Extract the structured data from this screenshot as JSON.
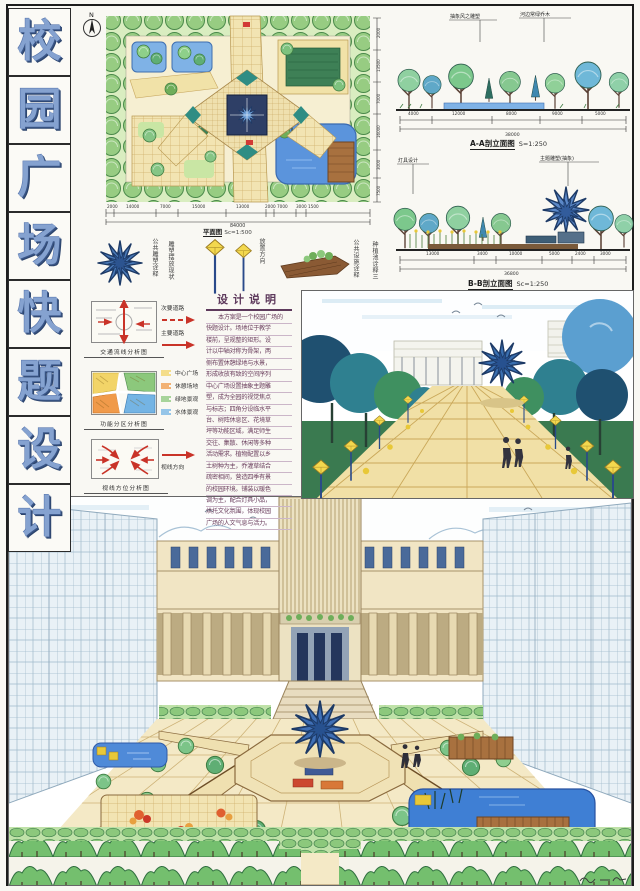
{
  "board": {
    "titles": [
      "校",
      "园",
      "广",
      "场",
      "快",
      "题",
      "设",
      "计"
    ]
  },
  "plan": {
    "north": "N",
    "label": "平面图",
    "scale": "Sc=1:500",
    "dim_total": "84000",
    "dims_bottom": [
      "2000",
      "14000",
      "7000",
      "15000",
      "13000",
      "2000",
      "7000",
      "3000",
      "1500"
    ],
    "dims_right": [
      "2000",
      "13500",
      "7000",
      "16000",
      "3000",
      "7500"
    ]
  },
  "sections": {
    "a": {
      "callout_left": "抽象风之雕塑",
      "callout_right": "河边常绿乔木",
      "label": "A-A剖立面图",
      "scale": "S=1:250",
      "dims": [
        "4000",
        "12000",
        "8000",
        "9000",
        "5000"
      ],
      "total": "38000"
    },
    "b": {
      "callout_left": "灯具设计",
      "callout_right": "主题雕塑(抽象)",
      "label": "B-B剖立面图",
      "scale": "Sc=1:250",
      "dims": [
        "13000",
        "3400",
        "10000",
        "5000",
        "2400",
        "3000"
      ],
      "total": "36800"
    }
  },
  "details": {
    "captions": [
      "公共雕塑诠释",
      "雕塑摆放现状",
      "放置方向",
      "公共设施诠释",
      "种植池诠释三"
    ]
  },
  "analysis": {
    "traffic": {
      "caption": "交通流线分析图",
      "legend": [
        {
          "label": "次要道路",
          "style": "dashed"
        },
        {
          "label": "主要道路",
          "style": "solid"
        }
      ],
      "arrow_color": "#c93328"
    },
    "zoning": {
      "caption": "功能分区分析图",
      "legend": [
        {
          "label": "中心广场",
          "color": "#f2d468"
        },
        {
          "label": "休憩场地",
          "color": "#f09a4a"
        },
        {
          "label": "绿地景观",
          "color": "#8cc87c"
        },
        {
          "label": "水体景观",
          "color": "#74b4e4"
        }
      ]
    },
    "sight": {
      "caption": "视线方位分析图",
      "legend": [
        {
          "label": "视线方向"
        }
      ],
      "arrow_color": "#c93328"
    }
  },
  "notes": {
    "title": "设计说明",
    "lines": [
      "本方案是一个校园广场的",
      "快题设计。场地位于教学",
      "楼前，呈规整的矩形。设",
      "计以中轴对称为骨架，两",
      "侧布置休憩绿地与水景，",
      "形成收放有致的空间序列",
      "中心广场设置抽象主题雕",
      "塑，成为全园的视觉焦点",
      "与标志；四角分设临水平",
      "台、树阵休息区、花境草",
      "坪等功能区域，满足师生",
      "交往、集散、休闲等多种",
      "活动需求。植物配置以乡",
      "土树种为主，乔灌草结合",
      "疏密相间，营造四季有景",
      "的校园环境。铺装以暖色",
      "调为主，配合灯具小品，",
      "烘托文化氛围，体现校园",
      "广场的人文气息与活力。"
    ]
  },
  "colors": {
    "title_blue": "#85a2d0",
    "accent_red": "#c93328",
    "water_blue": "#5b94dc",
    "paving_cream": "#f2e4b2",
    "tree_green": "#8cc87c",
    "note_ink": "#6b3f5e"
  }
}
